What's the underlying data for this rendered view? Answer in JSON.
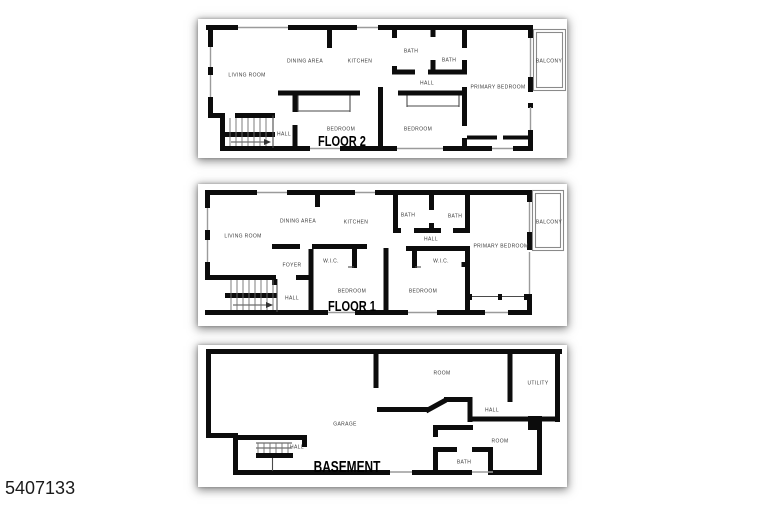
{
  "photo_id": "5407133",
  "colors": {
    "wall": "#0c0c0c",
    "window_line": "#9b9b9b",
    "detail_line": "#4a4a4a",
    "label_text": "#3b3b3b",
    "sheet_bg": "#ffffff"
  },
  "floors": [
    {
      "title": "FLOOR 2",
      "rooms": [
        "LIVING ROOM",
        "DINING AREA",
        "KITCHEN",
        "BATH",
        "BATH",
        "HALL",
        "PRIMARY BEDROOM",
        "BALCONY",
        "BEDROOM",
        "BEDROOM",
        "HALL"
      ]
    },
    {
      "title": "FLOOR 1",
      "rooms": [
        "LIVING ROOM",
        "DINING AREA",
        "KITCHEN",
        "BATH",
        "BATH",
        "HALL",
        "PRIMARY BEDROOM",
        "BALCONY",
        "FOYER",
        "W.I.C.",
        "W.I.C.",
        "BEDROOM",
        "BEDROOM",
        "HALL"
      ]
    },
    {
      "title": "BASEMENT",
      "rooms": [
        "GARAGE",
        "ROOM",
        "UTILITY",
        "HALL",
        "ROOM",
        "BATH",
        "HALL"
      ]
    }
  ]
}
